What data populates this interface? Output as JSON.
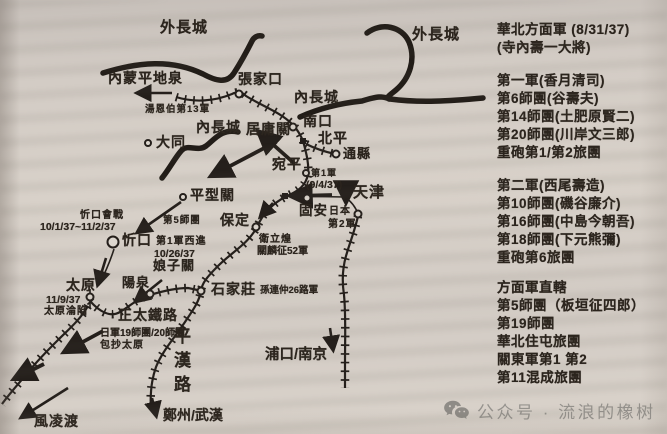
{
  "map": {
    "labels": {
      "outer_wall_left": "外長城",
      "outer_wall_right": "外長城",
      "inner_wall_left": "內長城",
      "inner_wall_right": "內長城",
      "pingdiquan": "內蒙平地泉",
      "zhangjiakou": "張家口",
      "tang_enbo_13army": "湯恩伯第13軍",
      "juyongguan": "居庸關",
      "nankou": "南口",
      "datong": "大同",
      "beiping": "北平",
      "tongxian": "通縣",
      "wanping": "宛平",
      "army1": "第1軍",
      "army1_date": "(9/4/37)",
      "tianjin": "天津",
      "guan": "固安",
      "japan": "日本",
      "army2": "第2軍",
      "pingxingguan": "平型關",
      "div5": "第5師團",
      "xinkou_battle": "忻口會戰",
      "xinkou_dates": "10/1/37~11/2/37",
      "xinkou": "忻口",
      "army1_west": "第1軍西進",
      "army1_west_date": "10/26/37",
      "niangziguan": "娘子關",
      "baoding": "保定",
      "wei_lihuang": "衛立煌",
      "guan_linzheng_52army": "關麟征52軍",
      "taiyuan": "太原",
      "taiyuan_date": "11/9/37",
      "taiyuan_fall": "太原淪陷",
      "jp_div_19_20": "日軍19師團/20師團",
      "encircle_taiyuan": "包抄太原",
      "yangquan": "陽泉",
      "zhengtai_railway": "正太鐵路",
      "shijiazhuang": "石家莊",
      "sun_lianzhong_26army": "孫連仲26路軍",
      "pinghan_railway": "平漢路",
      "zhengzhou_wuhan": "鄭州/武漢",
      "fenglingdu": "風凌渡",
      "pukou_nanjing": "浦口/南京"
    }
  },
  "legend": {
    "lines": [
      "華北方面軍 (8/31/37)",
      "(寺內壽一大將)",
      "第一軍(香月清司)",
      "第6師團(谷壽夫)",
      "第14師團(土肥原賢二)",
      "第20師團(川岸文三郎)",
      "重砲第1/第2旅團",
      "第二軍(西尾壽造)",
      "第10師團(磯谷廉介)",
      "第16師團(中島今朝吾)",
      "第18師團(下元熊彌)",
      "重砲第6旅團",
      "方面軍直轄",
      "第5師團（板垣征四郎）",
      "第19師團",
      "華北住屯旅團",
      "關東軍第1 第2",
      "第11混成旅團"
    ]
  },
  "watermark": {
    "icon": "wechat-icon",
    "text": "公众号 · 流浪的橡树"
  }
}
